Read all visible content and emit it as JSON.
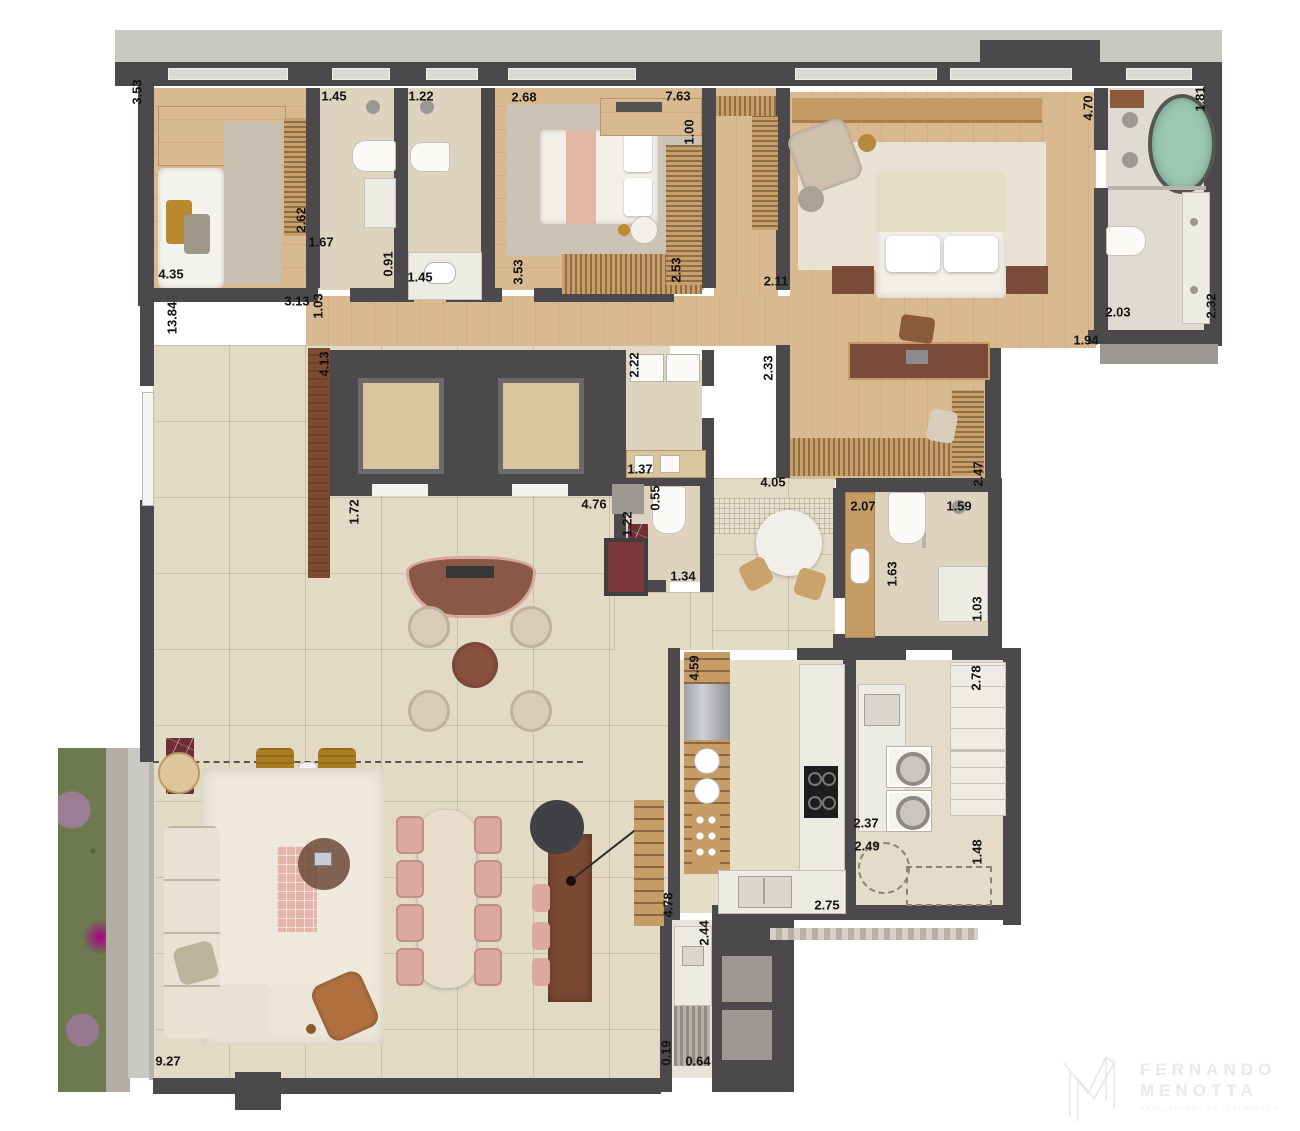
{
  "dims": [
    {
      "v": "3.53"
    },
    {
      "v": "4.35"
    },
    {
      "v": "2.62"
    },
    {
      "v": "1.67"
    },
    {
      "v": "0.91"
    },
    {
      "v": "1.45"
    },
    {
      "v": "1.22"
    },
    {
      "v": "1.45"
    },
    {
      "v": "3.13"
    },
    {
      "v": "1.03"
    },
    {
      "v": "13.84"
    },
    {
      "v": "2.68"
    },
    {
      "v": "7.63"
    },
    {
      "v": "1.00"
    },
    {
      "v": "3.53"
    },
    {
      "v": "2.53"
    },
    {
      "v": "2.11"
    },
    {
      "v": "2.33"
    },
    {
      "v": "4.70"
    },
    {
      "v": "1.81"
    },
    {
      "v": "2.03"
    },
    {
      "v": "2.32"
    },
    {
      "v": "1.94"
    },
    {
      "v": "4.13"
    },
    {
      "v": "1.72"
    },
    {
      "v": "2.22"
    },
    {
      "v": "1.37"
    },
    {
      "v": "0.55"
    },
    {
      "v": "4.76"
    },
    {
      "v": "1.22"
    },
    {
      "v": "1.34"
    },
    {
      "v": "4.05"
    },
    {
      "v": "2.47"
    },
    {
      "v": "2.07"
    },
    {
      "v": "1.59"
    },
    {
      "v": "1.63"
    },
    {
      "v": "1.03"
    },
    {
      "v": "4.59"
    },
    {
      "v": "2.78"
    },
    {
      "v": "2.37"
    },
    {
      "v": "2.49"
    },
    {
      "v": "1.48"
    },
    {
      "v": "2.75"
    },
    {
      "v": "4.78"
    },
    {
      "v": "2.44"
    },
    {
      "v": "0.19"
    },
    {
      "v": "0.64"
    },
    {
      "v": "9.27"
    }
  ],
  "logo": {
    "line1": "FERNANDO",
    "line2": "MENOTTA",
    "tagline": "ARQUITETURA DE INTERIORES"
  }
}
